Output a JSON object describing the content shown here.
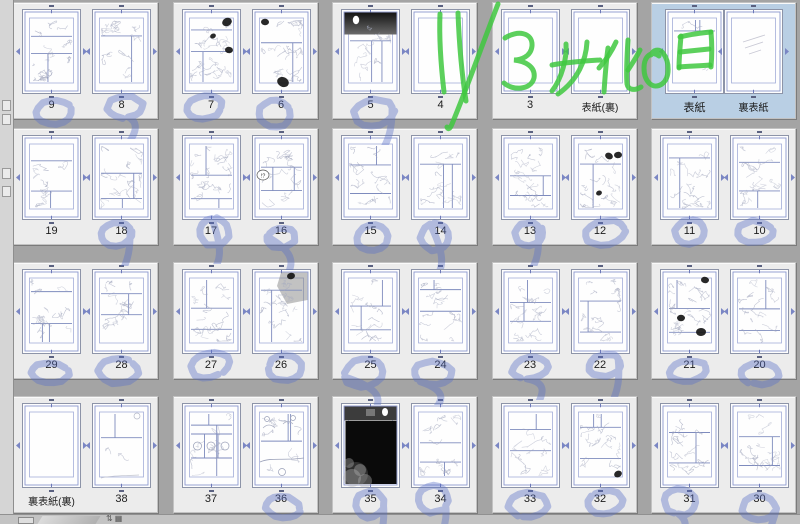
{
  "annotation": {
    "text": "11/3 女化の日",
    "color": "#3fc83f"
  },
  "colors": {
    "background": "#a4a4a4",
    "group_bg": "#ececec",
    "selected_bg": "#b9cfe4",
    "guide_blue": "#8b97cf",
    "guide_blue_light": "#a3add9",
    "panel_line": "#7e8bbd",
    "sketch_gray": "#a4a9bf",
    "stamp_blue": "#5a70c8",
    "label_color": "#1c1c1c"
  },
  "sidebar": {
    "icons": [
      "palette-page-icon",
      "palette-doc-icon",
      "palette-check-icon",
      "palette-tool-icon"
    ]
  },
  "bottombar": {
    "button": "corner-resize-button",
    "glyphs": "⇅▦"
  },
  "pages_grid": {
    "rows": [
      {
        "groups": [
          {
            "pages": [
              {
                "label": "9",
                "stamp": true,
                "density": 0.8
              },
              {
                "label": "8",
                "stamp": true,
                "density": 0.7
              }
            ]
          },
          {
            "pages": [
              {
                "label": "7",
                "stamp": true,
                "density": 0.95,
                "blobs": [
                  [
                    44,
                    12,
                    5
                  ],
                  [
                    46,
                    40,
                    4
                  ],
                  [
                    30,
                    26,
                    3
                  ]
                ]
              },
              {
                "label": "6",
                "stamp": true,
                "density": 0.95,
                "blobs": [
                  [
                    12,
                    12,
                    4
                  ],
                  [
                    30,
                    72,
                    6
                  ]
                ]
              }
            ]
          },
          {
            "pages": [
              {
                "label": "5",
                "stamp": true,
                "density": 0.55,
                "feature": "night_top"
              },
              {
                "label": "4",
                "stamp": false,
                "density": 0
              }
            ]
          },
          {
            "pages": [
              {
                "label": "3",
                "stamp": false,
                "density": 0
              },
              {
                "label": "表紙(裏)",
                "stamp": false,
                "density": 0
              }
            ]
          },
          {
            "selected": true,
            "spread": true,
            "pages": [
              {
                "label": "表紙",
                "stamp": false,
                "density": 0.12
              },
              {
                "label": "裏表紙",
                "stamp": false,
                "density": 0,
                "feature": "watermark"
              }
            ]
          }
        ]
      },
      {
        "groups": [
          {
            "pages": [
              {
                "label": "19",
                "stamp": false,
                "density": 0.5
              },
              {
                "label": "18",
                "stamp": true,
                "density": 0.8
              }
            ]
          },
          {
            "pages": [
              {
                "label": "17",
                "stamp": true,
                "density": 0.8
              },
              {
                "label": "16",
                "stamp": true,
                "density": 0.7,
                "feature": "bubble",
                "bubble_text": "!?"
              }
            ]
          },
          {
            "pages": [
              {
                "label": "15",
                "stamp": true,
                "density": 0.8
              },
              {
                "label": "14",
                "stamp": true,
                "density": 0.7
              }
            ]
          },
          {
            "pages": [
              {
                "label": "13",
                "stamp": true,
                "density": 0.75
              },
              {
                "label": "12",
                "stamp": true,
                "density": 0.8,
                "blobs": [
                  [
                    37,
                    20,
                    4
                  ],
                  [
                    46,
                    19,
                    4
                  ],
                  [
                    27,
                    57,
                    3
                  ]
                ]
              }
            ]
          },
          {
            "pages": [
              {
                "label": "11",
                "stamp": true,
                "density": 0.7
              },
              {
                "label": "10",
                "stamp": true,
                "density": 0.7
              }
            ]
          }
        ]
      },
      {
        "groups": [
          {
            "pages": [
              {
                "label": "29",
                "stamp": true,
                "density": 0.75
              },
              {
                "label": "28",
                "stamp": true,
                "density": 0.75
              }
            ]
          },
          {
            "pages": [
              {
                "label": "27",
                "stamp": true,
                "density": 0.7
              },
              {
                "label": "26",
                "stamp": true,
                "density": 0.8,
                "feature": "graywash",
                "blobs": [
                  [
                    38,
                    6,
                    4
                  ]
                ]
              }
            ]
          },
          {
            "pages": [
              {
                "label": "25",
                "stamp": true,
                "density": 0.6
              },
              {
                "label": "24",
                "stamp": true,
                "density": 0.75
              }
            ]
          },
          {
            "pages": [
              {
                "label": "23",
                "stamp": true,
                "density": 0.75
              },
              {
                "label": "22",
                "stamp": true,
                "density": 0.7
              }
            ]
          },
          {
            "pages": [
              {
                "label": "21",
                "stamp": true,
                "density": 0.9,
                "blobs": [
                  [
                    44,
                    10,
                    4
                  ],
                  [
                    20,
                    48,
                    4
                  ],
                  [
                    40,
                    62,
                    5
                  ]
                ]
              },
              {
                "label": "20",
                "stamp": true,
                "density": 0.6
              }
            ]
          }
        ]
      },
      {
        "groups": [
          {
            "pages": [
              {
                "label": "裏表紙(裏)",
                "stamp": false,
                "density": 0
              },
              {
                "label": "38",
                "stamp": false,
                "density": 0.08,
                "feature": "sparse"
              }
            ]
          },
          {
            "pages": [
              {
                "label": "37",
                "stamp": false,
                "density": 0.5,
                "feature": "threepanels"
              },
              {
                "label": "36",
                "stamp": true,
                "density": 0.45,
                "feature": "landscape"
              }
            ]
          },
          {
            "pages": [
              {
                "label": "35",
                "stamp": true,
                "density": 0,
                "feature": "blackpage"
              },
              {
                "label": "34",
                "stamp": true,
                "density": 0.75
              }
            ]
          },
          {
            "pages": [
              {
                "label": "33",
                "stamp": true,
                "density": 0.55
              },
              {
                "label": "32",
                "stamp": true,
                "density": 0.7,
                "blobs": [
                  [
                    46,
                    70,
                    4
                  ]
                ]
              }
            ]
          },
          {
            "pages": [
              {
                "label": "31",
                "stamp": true,
                "density": 0.7
              },
              {
                "label": "30",
                "stamp": true,
                "density": 0.7
              }
            ]
          }
        ]
      }
    ]
  }
}
